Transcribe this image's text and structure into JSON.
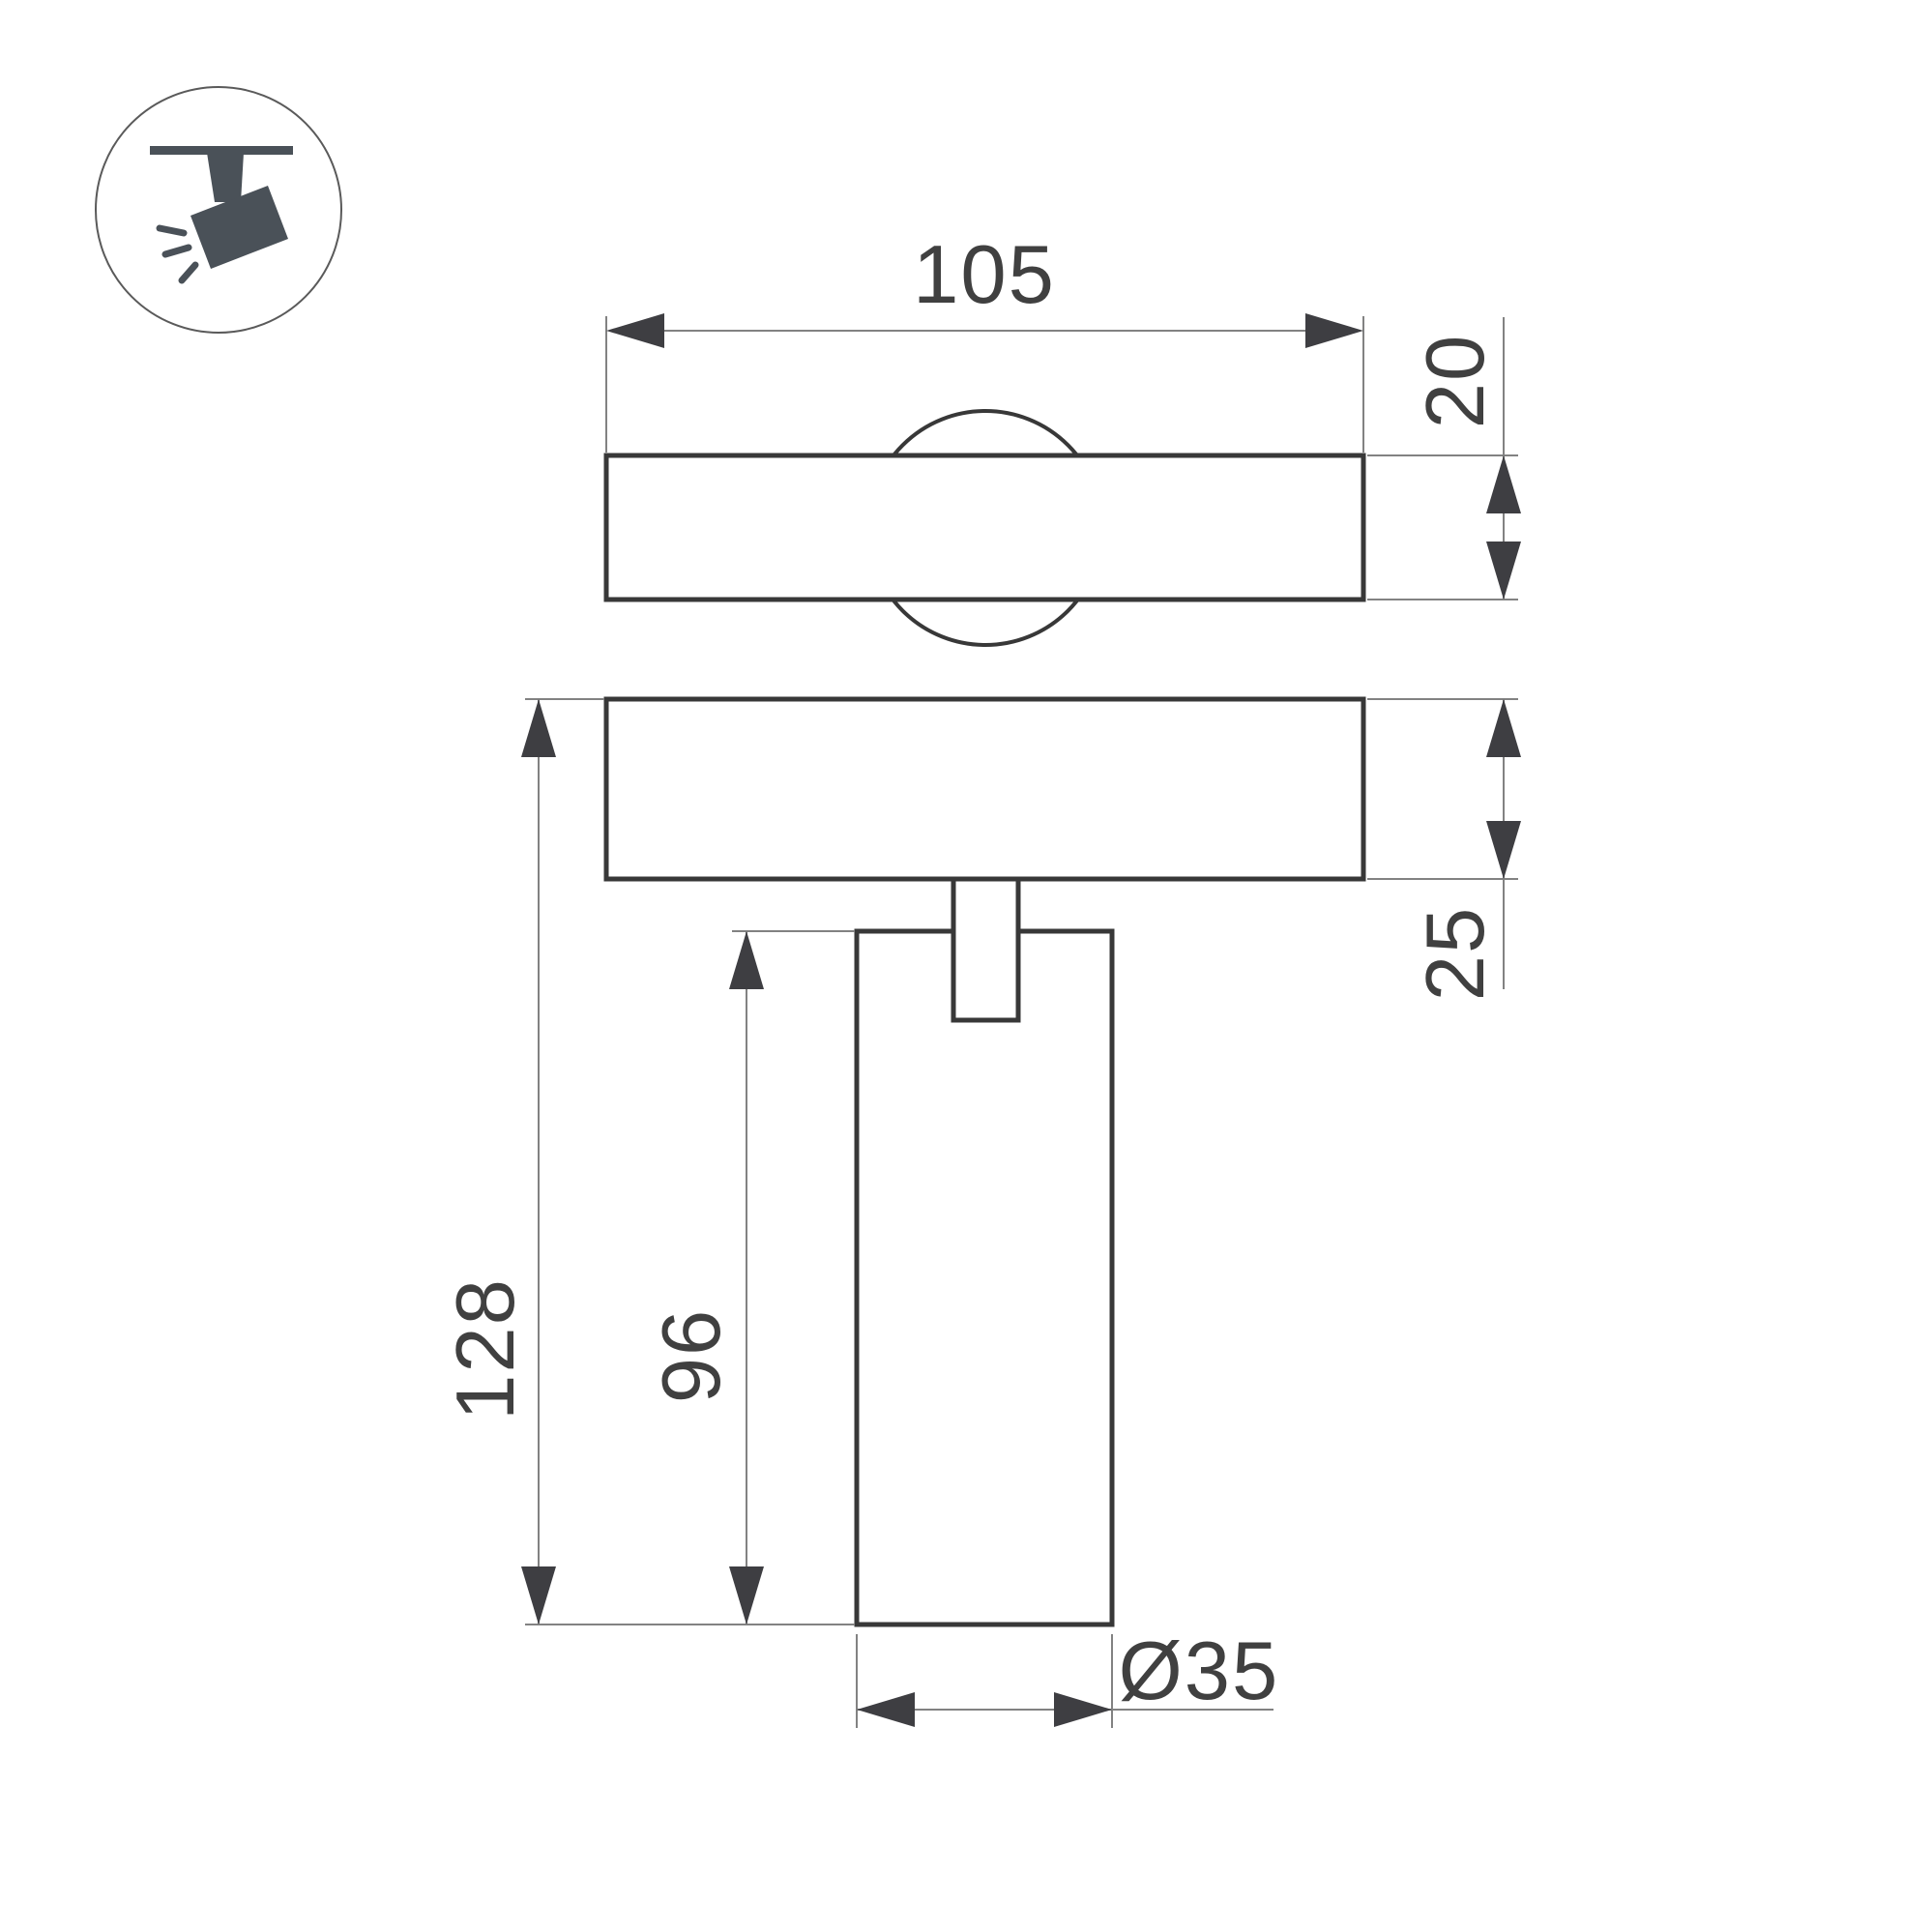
{
  "drawing": {
    "colors": {
      "outline": "#383838",
      "thin": "#828282",
      "arrow": "#3e3e42",
      "icon": "#4a5158",
      "text": "#404040",
      "background": "#ffffff"
    },
    "dimensions": {
      "width_top": "105",
      "height_top": "20",
      "height_plate": "25",
      "height_total": "128",
      "height_body": "96",
      "diameter_body": "Ø35"
    }
  }
}
